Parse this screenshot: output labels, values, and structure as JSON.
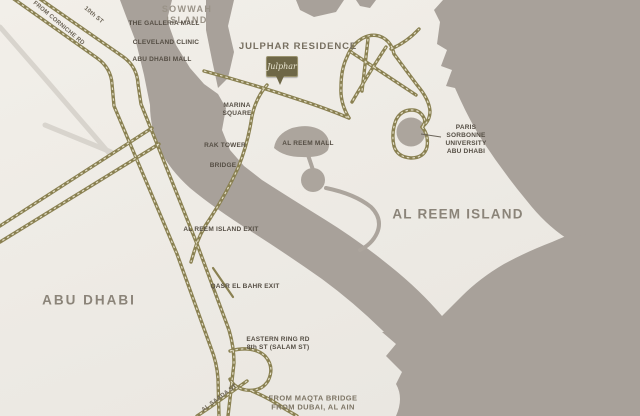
{
  "title": "Julphar Residence location map",
  "colors": {
    "land": "#edeae4",
    "water": "#a8a19a",
    "route": "#8a8152",
    "route-dash": "#e2ddc6",
    "secondary": "#d8d4cd",
    "label": "#554e44",
    "label-region": "#8b8479",
    "pin-fill": "#6e6747",
    "pin-text": "#eae6d2"
  },
  "regions": {
    "sowwah_island": "SOWWAH ISLAND",
    "abu_dhabi": "ABU DHABI",
    "al_reem_island": "AL REEM ISLAND"
  },
  "places": {
    "galleria_mall": "THE GALLERIA MALL",
    "cleveland_clinic": "CLEVELAND CLINIC",
    "abu_dhabi_mall": "ABU DHABI MALL",
    "julphar_residence": "JULPHAR RESIDENCE",
    "marina_square": "MARINA SQUARE",
    "rak_tower": "RAK TOWER",
    "bridge": "BRIDGE",
    "al_reem_mall": "AL REEM MALL",
    "sorbonne": "PARIS SORBONNE UNIVERSITY ABU DHABI"
  },
  "road_labels": {
    "from_corniche": "FROM CORNICHE RD",
    "tenth_st": "10th ST",
    "al_reem_island_exit": "AL REEM ISLAND EXIT",
    "qasr_el_bahr_exit": "QASR EL BAHR EXIT",
    "eastern_ring": "EASTERN RING RD\n8th ST (SALAM ST)",
    "al_saada_st": "AL SAADA ST",
    "maqta": "FROM MAQTA BRIDGE\nFROM DUBAI, AL AIN"
  },
  "marker": {
    "label": "Julphar"
  }
}
